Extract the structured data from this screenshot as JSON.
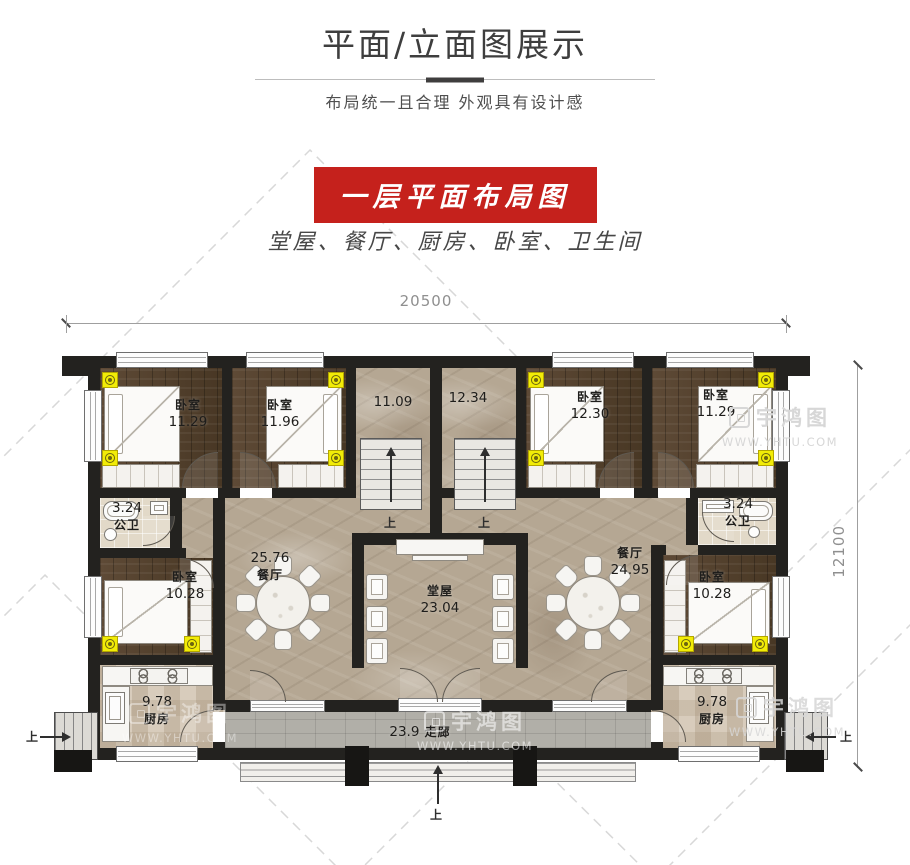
{
  "header": {
    "title": "平面/立面图展示",
    "subtitle": "布局统一且合理  外观具有设计感"
  },
  "section": {
    "banner": "一层平面布局图",
    "room_list": "堂屋、餐厅、厨房、卧室、卫生间"
  },
  "colors": {
    "banner_red": "#c5211c",
    "wall_black": "#23221f",
    "marker_yellow": "#f2ec07"
  },
  "plan": {
    "dim_top": "20500",
    "dim_right": "12100",
    "up": "上",
    "rooms": {
      "br_tl": {
        "name": "卧室",
        "area": "11.29"
      },
      "br_tl2": {
        "name": "卧室",
        "area": "11.96"
      },
      "stair_hall_left": {
        "area": "11.09"
      },
      "stair_hall_right": {
        "area": "12.34"
      },
      "br_tr": {
        "name": "卧室",
        "area": "12.30"
      },
      "br_tr2": {
        "name": "卧室",
        "area": "11.29"
      },
      "bath_left": {
        "name": "公卫",
        "area": "3.24"
      },
      "bath_right": {
        "name": "公卫",
        "area": "3.24"
      },
      "br_left": {
        "name": "卧室",
        "area": "10.28"
      },
      "br_right": {
        "name": "卧室",
        "area": "10.28"
      },
      "dining_left": {
        "name": "餐厅",
        "area": "25.76"
      },
      "dining_right": {
        "name": "餐厅",
        "area": "24.95"
      },
      "main_hall": {
        "name": "堂屋",
        "area": "23.04"
      },
      "kitchen_left": {
        "name": "厨房",
        "area": "9.78"
      },
      "kitchen_right": {
        "name": "厨房",
        "area": "9.78"
      },
      "corridor": {
        "name": "走廊",
        "area": "23.9"
      }
    }
  },
  "watermark": {
    "logo_text": "宇鸿图",
    "url": "WWW.YHTU.COM"
  }
}
